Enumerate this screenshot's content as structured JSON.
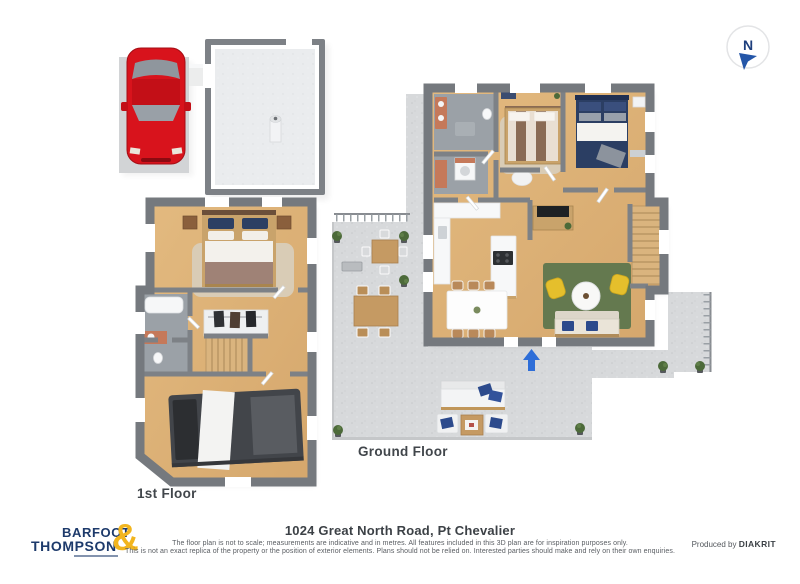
{
  "labels": {
    "ground_floor": "Ground Floor",
    "first_floor": "1st Floor"
  },
  "compass": {
    "north_label": "N"
  },
  "brand": {
    "name_line1": "BARFOOT",
    "name_line2": "THOMPSON",
    "ampersand": "&",
    "navy": "#1d3a6b",
    "gold": "#f2b51e"
  },
  "title_block": {
    "address": "1024 Great North Road, Pt Chevalier",
    "disclaimer_line1": "The floor plan is not to scale; measurements are indicative and in metres. All features included in this 3D plan are for inspiration purposes only.",
    "disclaimer_line2": "This is not an exact replica of the property or the position of exterior elements. Plans should not be relied on. Interested parties should make and rely on their own enquiries.",
    "produced_by_prefix": "Produced by",
    "producer": "DIAKRIT"
  },
  "colors": {
    "wall_gray": "#75797e",
    "wood_floor": "#ddb076",
    "bathroom_floor": "#9ba1a7",
    "patio_gray": "#d7d9db",
    "rug_green": "#64794f",
    "bed_navy": "#2b3e63",
    "chair_yellow": "#e5bf2c",
    "entry_arrow_blue": "#2e6ed8",
    "car_red": "#d8131c"
  }
}
